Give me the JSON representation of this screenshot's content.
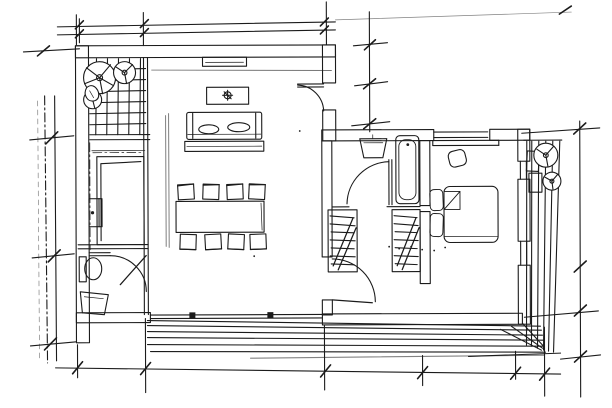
{
  "labels": {
    "canvas": "hand-drawn architectural floor plan sketch"
  },
  "colors": {
    "ink": "#1b1b1b",
    "paper": "#ffffff"
  },
  "drawing": {
    "elements": [
      "exterior-walls",
      "interior-partitions",
      "entry-tile-floor",
      "entry-plants",
      "kitchen-counter",
      "kitchen-appliance",
      "wc-toilet",
      "wc-sink",
      "wc-door",
      "sideboard",
      "coffee-table",
      "sofa",
      "sofa-rug",
      "dining-table",
      "dining-chairs",
      "living-room-door",
      "sliding-glass-door",
      "bathroom-sink",
      "bathtub",
      "bathroom-door",
      "wardrobe-left",
      "wardrobe-right",
      "closet-door",
      "bed",
      "pillows",
      "desk",
      "desk-chair",
      "deck-boards-bottom",
      "deck-boards-right",
      "deck-plants",
      "dimension-lines-top",
      "dimension-lines-left",
      "dimension-lines-bottom",
      "dimension-lines-right"
    ]
  }
}
